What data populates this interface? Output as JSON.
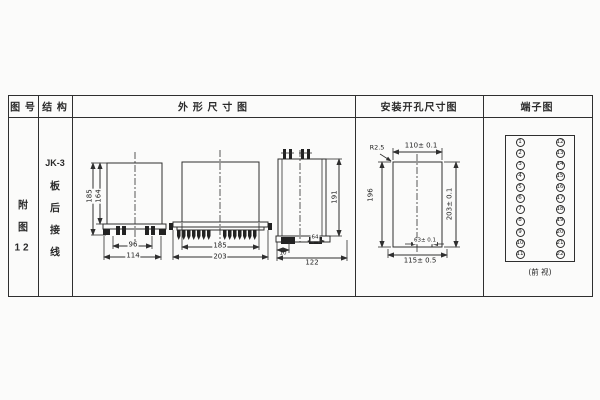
{
  "sheet": {
    "headers": {
      "fig_no": "图 号",
      "structure": "结 构",
      "outline": "外 形 尺 寸 图",
      "mounting": "安装开孔尺寸图",
      "terminal": "端子图"
    },
    "fig_no_lines": [
      "附",
      "图",
      "12"
    ],
    "structure_lines": [
      "JK-3",
      "板",
      "后",
      "接",
      "线"
    ]
  },
  "outline_front": {
    "h_outer": "185",
    "h_inner": "164",
    "w_inner": "96",
    "w_outer": "114"
  },
  "outline_mid": {
    "w_inner": "185",
    "w_outer": "203"
  },
  "outline_side": {
    "height": "191",
    "w_small": "10",
    "w_mid": "64",
    "w_total": "122"
  },
  "mounting": {
    "radius": "R2.5",
    "width_top": "110± 0.1",
    "height_left": "196",
    "height_right": "203± 0.1",
    "notch": "63± 0.1",
    "width_bottom": "115± 0.5"
  },
  "terminals": {
    "left": [
      "1",
      "2",
      "3",
      "4",
      "5",
      "6",
      "7",
      "8",
      "9",
      "10",
      "11"
    ],
    "right": [
      "12",
      "13",
      "14",
      "15",
      "16",
      "17",
      "18",
      "19",
      "20",
      "21",
      "22"
    ],
    "caption": "(前 视)"
  }
}
